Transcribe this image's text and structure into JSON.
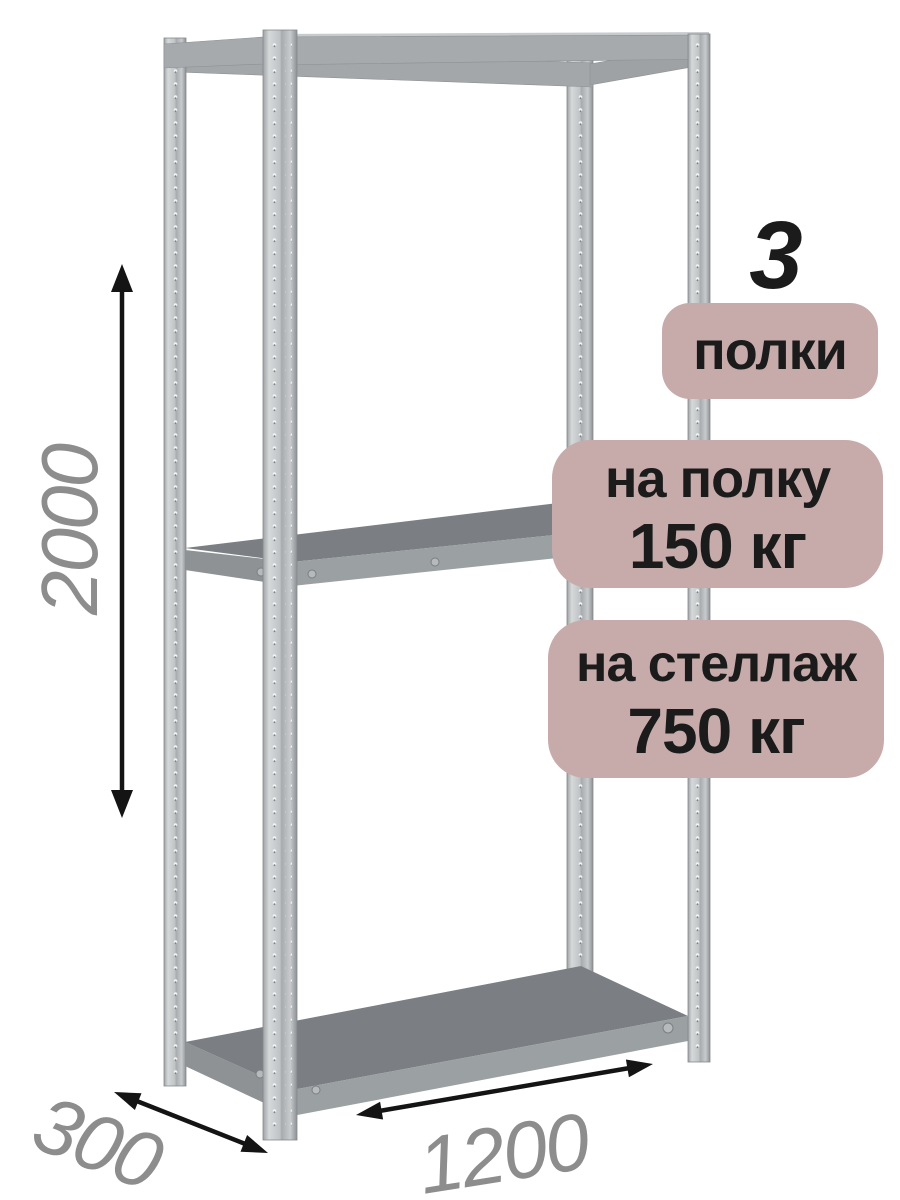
{
  "product_card": {
    "shelf_count_number": "3",
    "shelf_count_label": "полки",
    "shelf_load_badge": {
      "line1": "на полку",
      "line2": "150 кг"
    },
    "rack_load_badge": {
      "line1": "на стеллаж",
      "line2": "750 кг"
    },
    "dimensions": {
      "height_mm": "2000",
      "depth_mm": "300",
      "width_mm": "1200"
    },
    "colors": {
      "badge_background": "#c7abaa",
      "badge_text": "#1b1b1b",
      "dimension_text": "#8d8d8d",
      "arrow_color": "#141414",
      "shelf_top_color": "#7b7f83",
      "shelf_front_color": "#9ba0a3",
      "post_color": "#c2c6c8",
      "background": "#ffffff"
    }
  }
}
